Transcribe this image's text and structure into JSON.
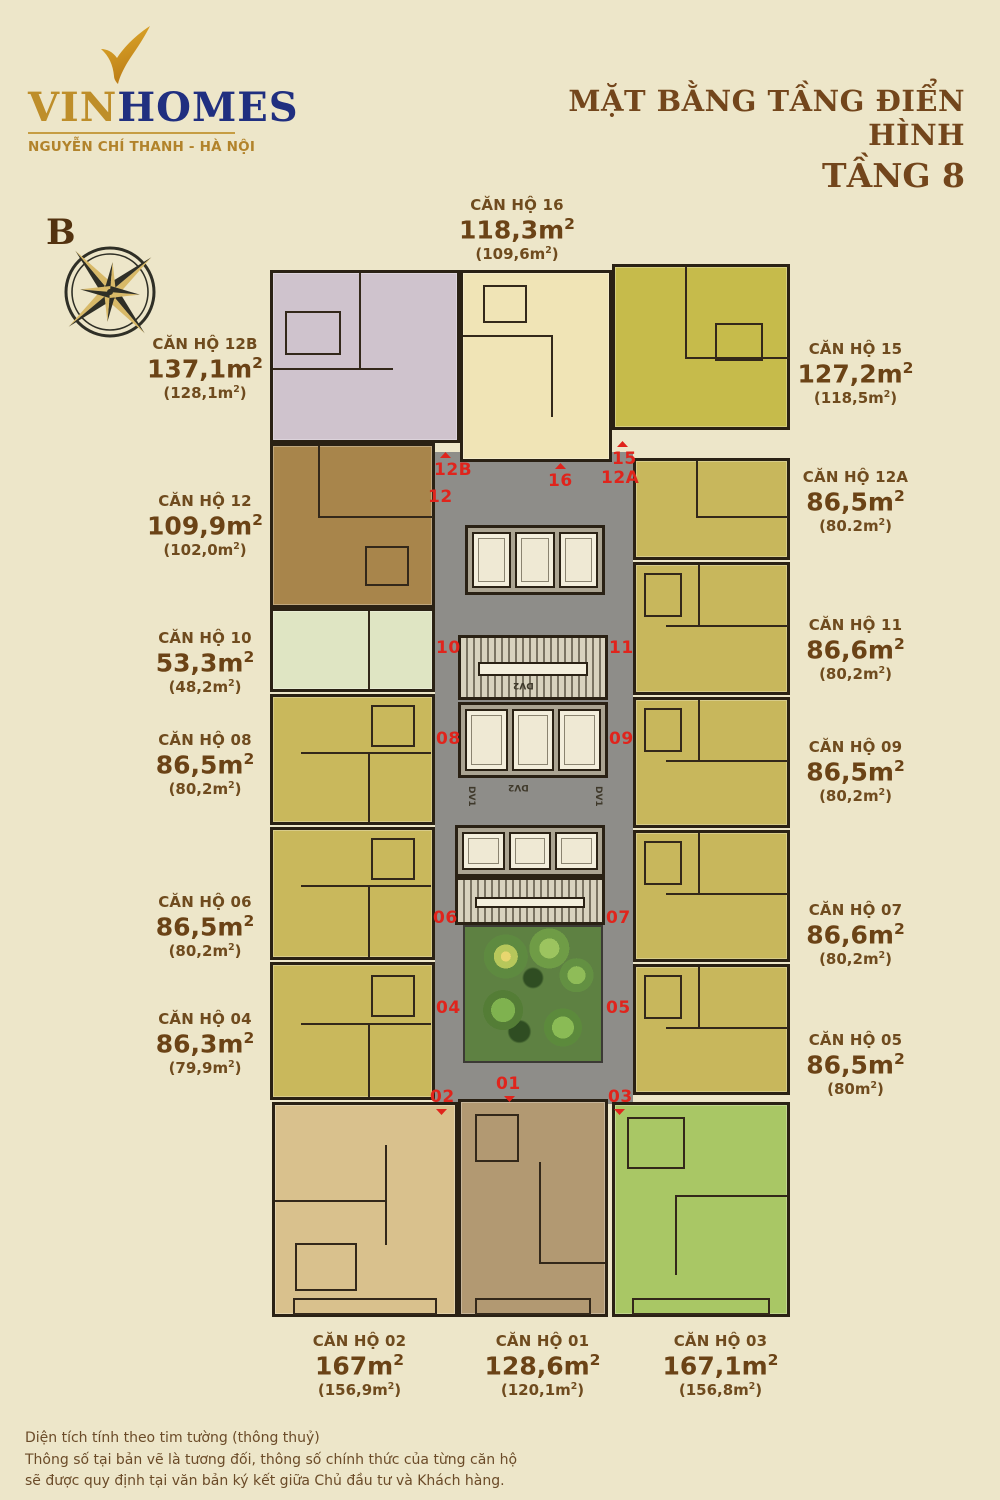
{
  "brand": {
    "vin": "VIN",
    "homes": "HOMES",
    "subtitle": "NGUYỄN CHÍ THANH - HÀ NỘI"
  },
  "title": {
    "line1": "MẶT BẰNG TẦNG ĐIỂN HÌNH",
    "line2": "TẦNG 8"
  },
  "compass": {
    "north_label": "B"
  },
  "units": {
    "sup": "2",
    "close": ")"
  },
  "core": {
    "dv1": "DV1",
    "dv2": "DV2"
  },
  "apartments": [
    {
      "no": "16",
      "name": "CĂN HỘ 16",
      "area": "118,3m",
      "net": "(109,6m",
      "color": "#F0E4B6"
    },
    {
      "no": "12B",
      "name": "CĂN HỘ 12B",
      "area": "137,1m",
      "net": "(128,1m",
      "color": "#CFC3CD"
    },
    {
      "no": "15",
      "name": "CĂN HỘ 15",
      "area": "127,2m",
      "net": "(118,5m",
      "color": "#C6BB4B"
    },
    {
      "no": "12",
      "name": "CĂN HỘ 12",
      "area": "109,9m",
      "net": "(102,0m",
      "color": "#A8854B"
    },
    {
      "no": "12A",
      "name": "CĂN HỘ 12A",
      "area": "86,5m",
      "net": "(80.2m",
      "color": "#C8B75C"
    },
    {
      "no": "10",
      "name": "CĂN HỘ 10",
      "area": "53,3m",
      "net": "(48,2m",
      "color": "#DFE5C3"
    },
    {
      "no": "11",
      "name": "CĂN HỘ 11",
      "area": "86,6m",
      "net": "(80,2m",
      "color": "#C8B75C"
    },
    {
      "no": "08",
      "name": "CĂN HỘ 08",
      "area": "86,5m",
      "net": "(80,2m",
      "color": "#C9B85C"
    },
    {
      "no": "09",
      "name": "CĂN HỘ 09",
      "area": "86,5m",
      "net": "(80,2m",
      "color": "#C8B75C"
    },
    {
      "no": "06",
      "name": "CĂN HỘ 06",
      "area": "86,5m",
      "net": "(80,2m",
      "color": "#C9B85C"
    },
    {
      "no": "07",
      "name": "CĂN HỘ 07",
      "area": "86,6m",
      "net": "(80,2m",
      "color": "#C8B75C"
    },
    {
      "no": "04",
      "name": "CĂN HỘ 04",
      "area": "86,3m",
      "net": "(79,9m",
      "color": "#C9B85C"
    },
    {
      "no": "05",
      "name": "CĂN HỘ 05",
      "area": "86,5m",
      "net": "(80m",
      "color": "#C8B75C"
    },
    {
      "no": "02",
      "name": "CĂN HỘ 02",
      "area": "167m",
      "net": "(156,9m",
      "color": "#D9C18D"
    },
    {
      "no": "01",
      "name": "CĂN HỘ 01",
      "area": "128,6m",
      "net": "(120,1m",
      "color": "#B29972"
    },
    {
      "no": "03",
      "name": "CĂN HỘ 03",
      "area": "167,1m",
      "net": "(156,8m",
      "color": "#A9C765"
    }
  ],
  "footer": {
    "line1": "Diện tích tính theo tim tường (thông thuỷ)",
    "line2": "Thông số tại bản vẽ là tương đối, thông số chính thức của từng căn hộ",
    "line3": "sẽ được quy định tại văn bản ký kết giữa Chủ đầu tư và Khách hàng."
  },
  "colors": {
    "background": "#EDE6C9",
    "corridor": "#8E8D89",
    "wall": "#2A2114",
    "marker_red": "#E0241C",
    "label_brown": "#6F4B1E",
    "title_brown": "#73461C",
    "logo_gold": "#BE8E2A",
    "logo_navy": "#202F80",
    "core_cream": "#F2EDDB",
    "garden_green": "#5E8142"
  }
}
